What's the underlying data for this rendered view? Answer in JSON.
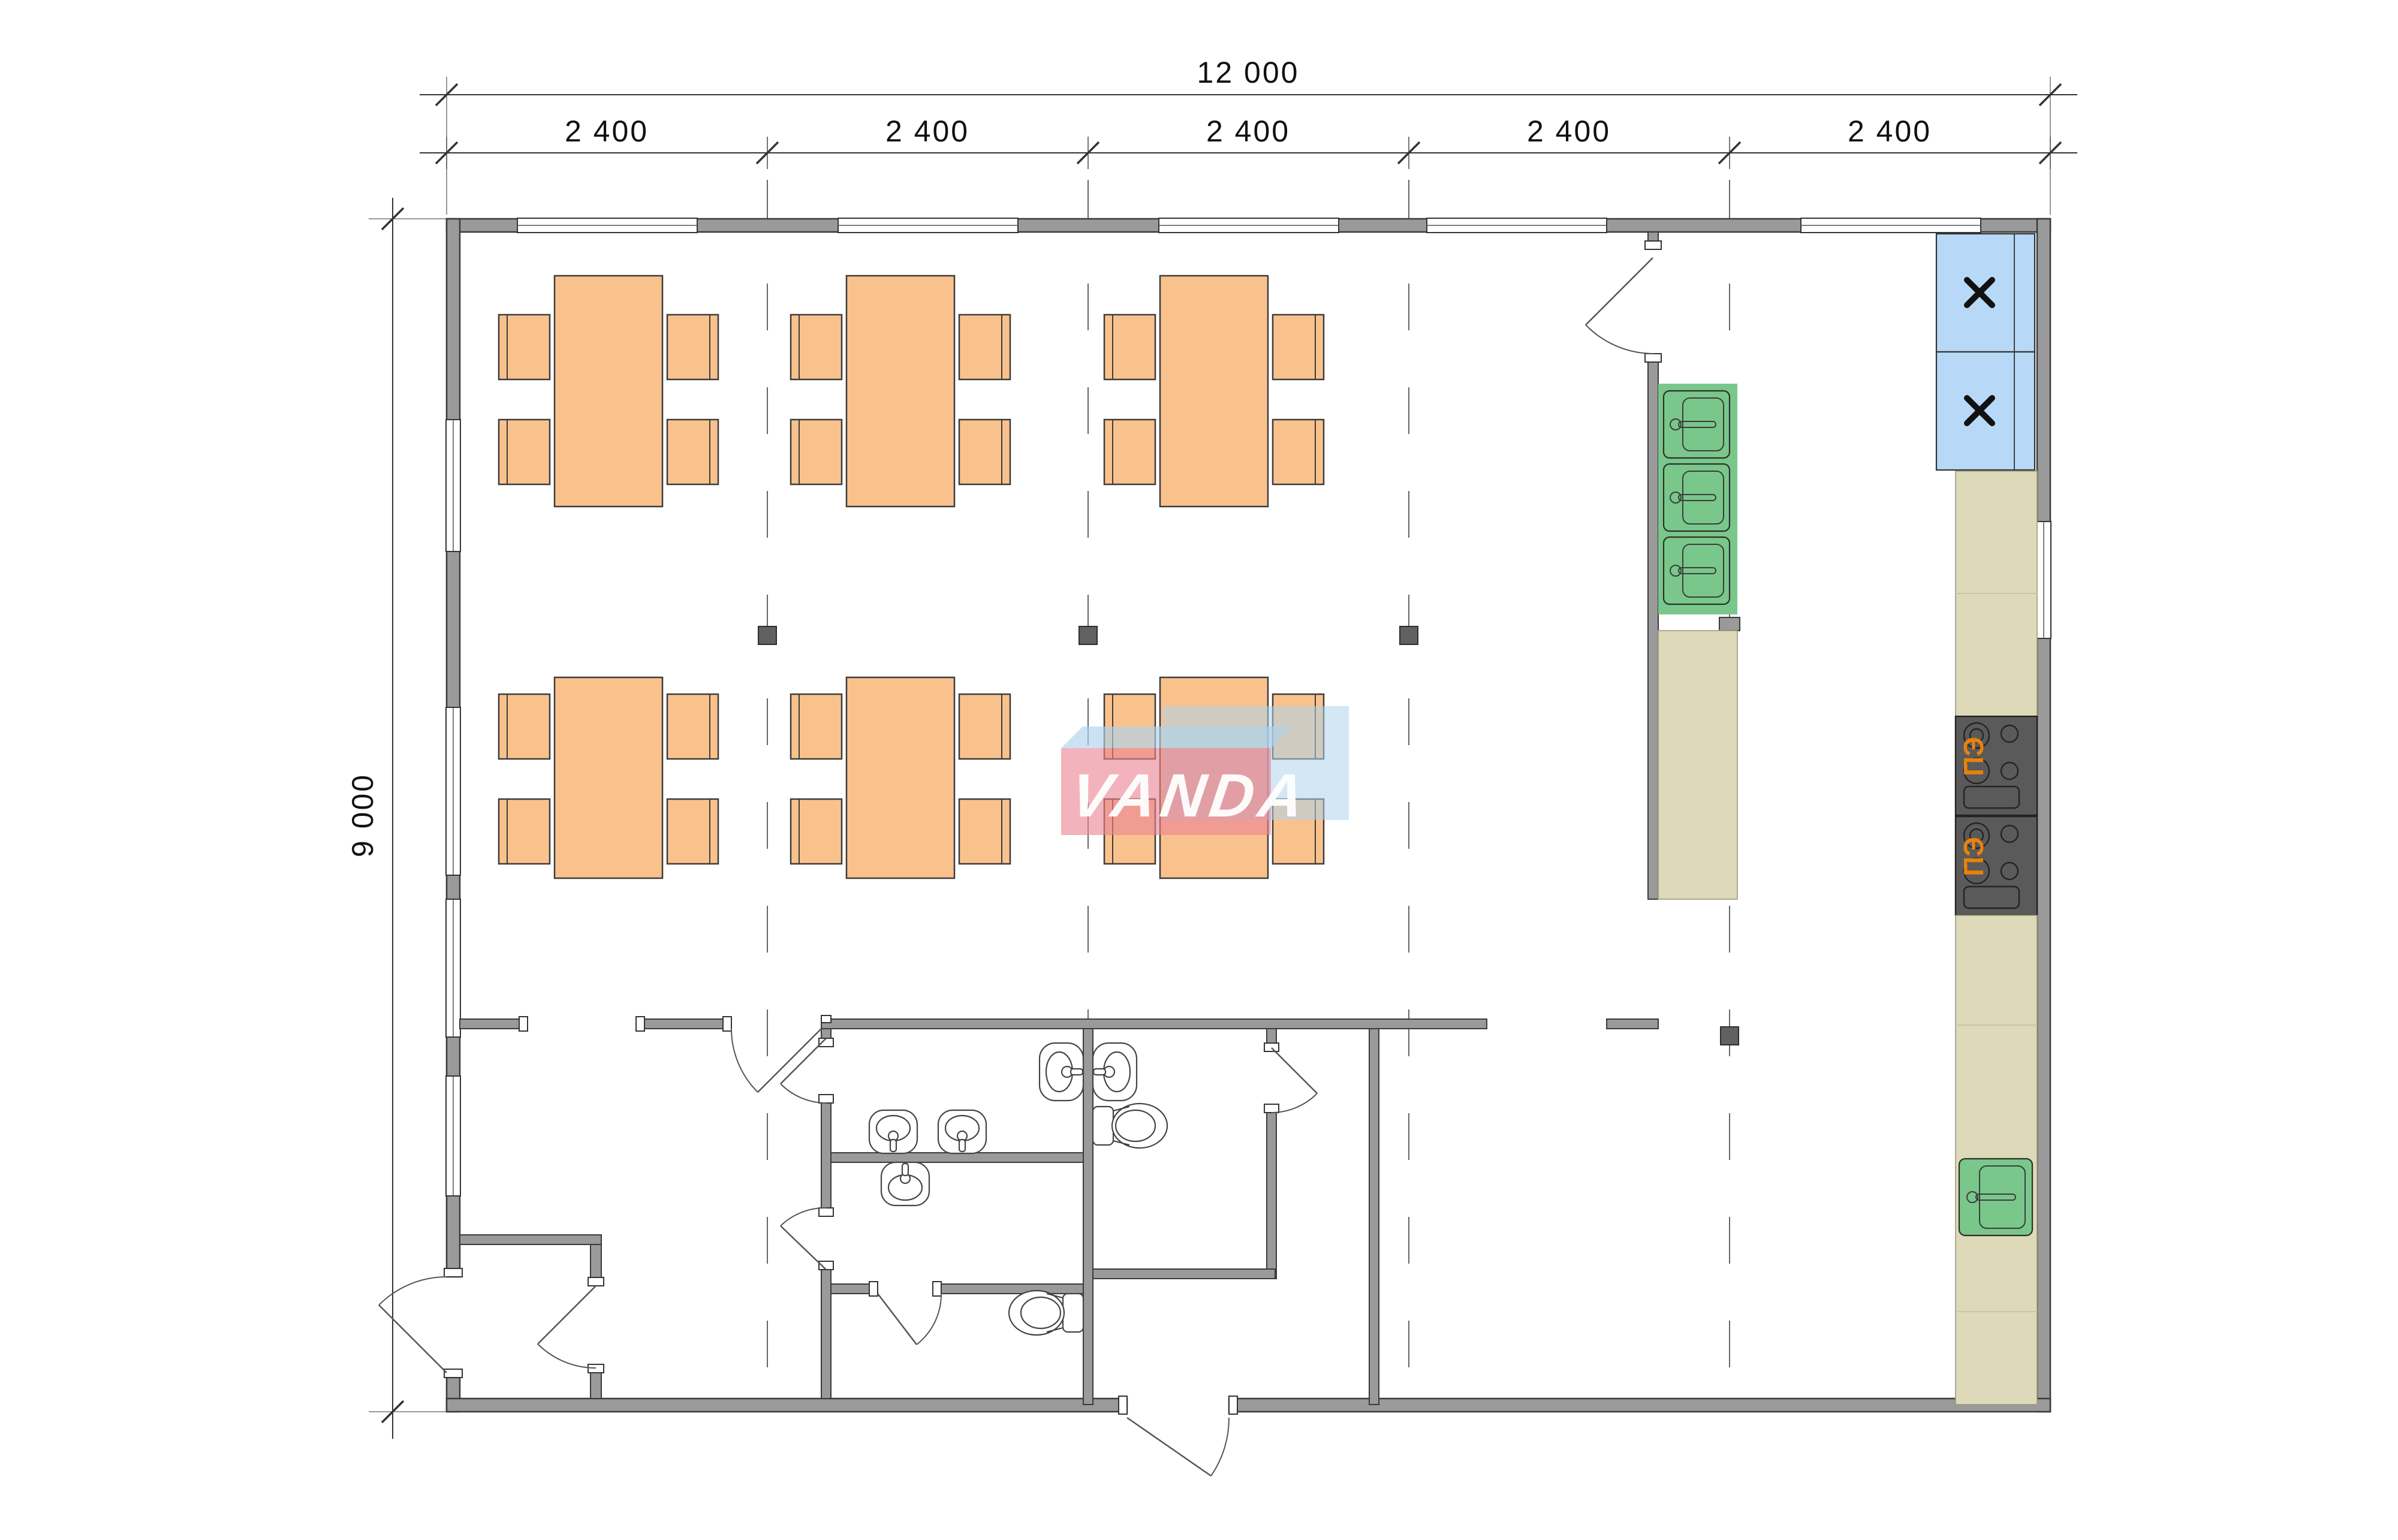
{
  "drawing": {
    "type": "floor-plan",
    "dimensions": {
      "total_width_label": "12 000",
      "height_label": "9 000",
      "segment_labels": [
        "2 400",
        "2 400",
        "2 400",
        "2 400",
        "2 400"
      ]
    },
    "watermark": {
      "text": "VANDA"
    },
    "appliances": {
      "stove_label": "ПЭ"
    },
    "colors": {
      "wall_gray": "#9a9a9a",
      "furniture_orange": "#f9c28d",
      "sink_green": "#79c78b",
      "fridge_blue": "#b7d9f7",
      "counter_beige": "#ded9b8",
      "stove_dark": "#5a5a5a",
      "stove_label_orange": "#e8820d",
      "watermark_pink": "#ec8494",
      "watermark_blue": "#aed3ec"
    }
  }
}
